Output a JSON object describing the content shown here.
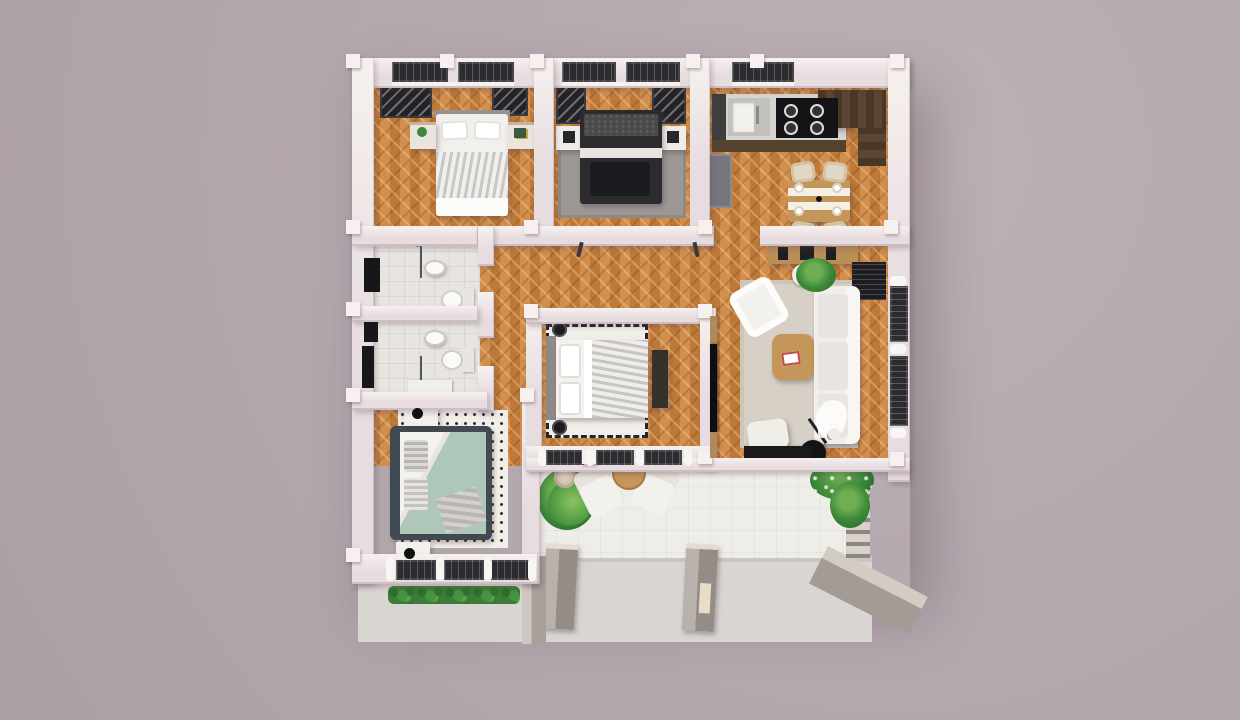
{
  "scene": {
    "title": "3D top-view floor plan render of a single-storey house",
    "view": "top-down isometric render",
    "visible_text": "none"
  },
  "palette": {
    "bg": "#b2a7ad",
    "bg-light": "#bcb1b6",
    "wall-top": "#f6f1ee",
    "wall-face": "#e7dcdf",
    "wood-base": "#c8813f",
    "tile": "#e8e5e0",
    "terrace": "#efede8",
    "concrete": "#d9d5d0",
    "concrete-dark": "#a39c96",
    "window-glass": "#2b2b30",
    "counter-front": "#54422f",
    "table-wood": "#c49659",
    "rug-gray": "#9c9894",
    "rug-beige": "#d7d0c6",
    "rug-white": "#f1eee9",
    "sofa-white": "#f1efec",
    "bed-dark": "#2c2b2f",
    "bed-frame-slate": "#3f4a52",
    "duvet-sage": "#aec7b9",
    "plant-green": "#3c8a39",
    "lamp-black": "#141416"
  },
  "rooms": [
    {
      "id": "bedroom-top-left",
      "floor": "herringbone-wood",
      "contents": [
        "wardrobe",
        "double-bed-white-striped-duvet",
        "nightstand-left-with-plant",
        "nightstand-right",
        "two-windows-top-wall"
      ]
    },
    {
      "id": "bedroom-top-middle",
      "floor": "herringbone-wood",
      "contents": [
        "wardrobe",
        "double-bed-dark",
        "gray-rug",
        "marble-nightstands",
        "two-windows-top-wall"
      ]
    },
    {
      "id": "kitchen",
      "floor": "herringbone-wood",
      "contents": [
        "sink",
        "cooktop-4-burner",
        "counter-dark-front",
        "fridge",
        "dark-wood-corner-counter",
        "dining-table-with-runner",
        "four-wicker-chairs",
        "plates",
        "window-top-wall",
        "sideboard"
      ]
    },
    {
      "id": "bathroom-upper",
      "floor": "gray-tile",
      "contents": [
        "shower-glass",
        "wash-basin",
        "toilet",
        "towel-radiator"
      ]
    },
    {
      "id": "bathroom-lower",
      "floor": "gray-tile",
      "contents": [
        "shower-glass",
        "wash-basin",
        "toilet",
        "vanity",
        "towel-radiator"
      ]
    },
    {
      "id": "bedroom-center",
      "floor": "herringbone-wood",
      "contents": [
        "rug-checker-border",
        "double-bed-horizontal",
        "foot-bench",
        "two-round-stools",
        "window-wall-with-curtains",
        "tv-on-partition-wall"
      ]
    },
    {
      "id": "living-room",
      "floor": "herringbone-wood",
      "contents": [
        "beige-rug",
        "white-sofa",
        "armchair",
        "coffee-table-with-book",
        "ottoman",
        "potted-plant",
        "floor-lamp",
        "black-doormat",
        "slatted-console",
        "windows-right-wall"
      ]
    },
    {
      "id": "bedroom-bottom-left",
      "floor": "herringbone-wood",
      "contents": [
        "speckled-rug",
        "double-bed-sage-duvet",
        "nightstands-with-black-lamps",
        "window-wall-three-panes",
        "hedge-outside"
      ]
    },
    {
      "id": "hallway",
      "floor": "herringbone-wood",
      "contents": []
    },
    {
      "id": "terrace",
      "floor": "white-tile",
      "contents": [
        "two-lounge-chairs",
        "half-round-table",
        "palm-plant",
        "planter-pot",
        "pergola-trellis-with-vines",
        "two-entry-pillars",
        "concrete-apron",
        "side-ramp"
      ]
    }
  ]
}
